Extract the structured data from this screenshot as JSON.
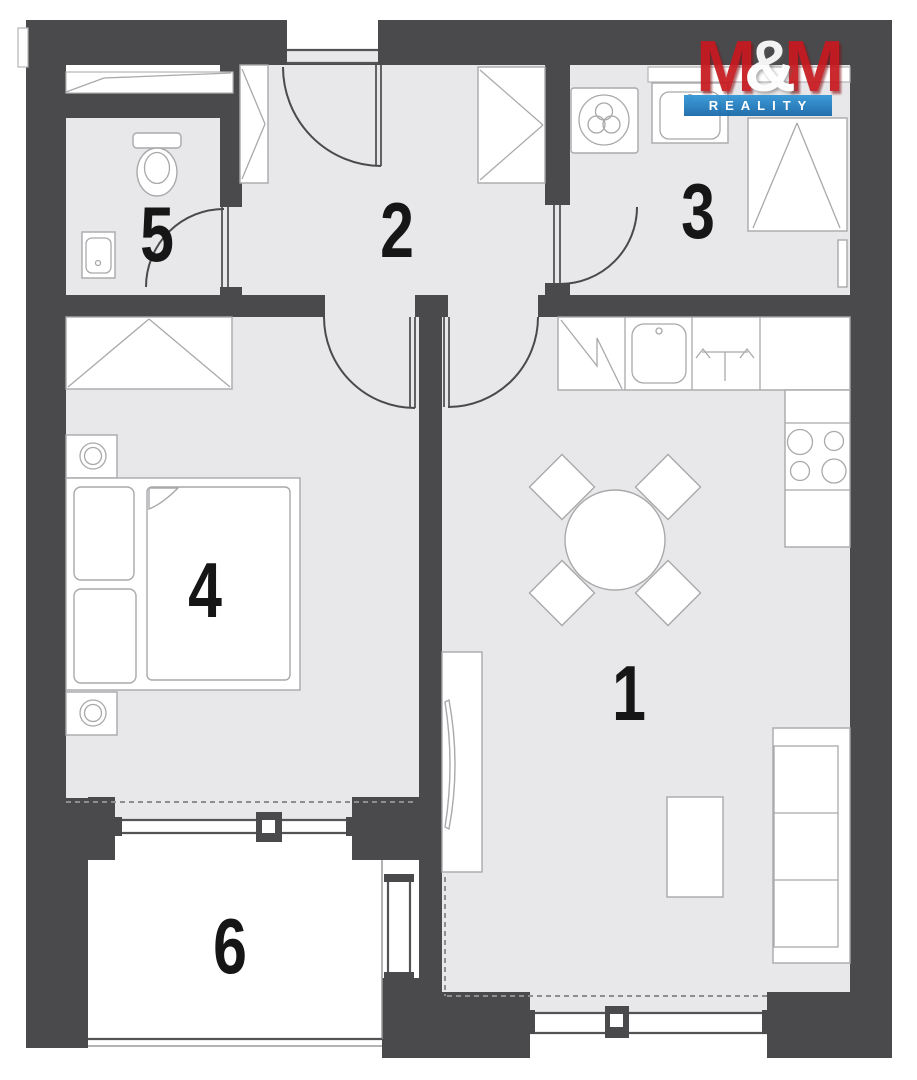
{
  "logo": {
    "m1": "M",
    "amp": "&",
    "m2": "M",
    "subtitle": "REALITY",
    "red": "#c7191f",
    "blue_top": "#2f95d6",
    "blue_bottom": "#1566a8"
  },
  "colors": {
    "wall": "#4a4a4c",
    "floor": "#e8e8ea",
    "balcony": "#ffffff",
    "furniture_stroke": "#a9a9ab",
    "label": "#161616"
  },
  "rooms": [
    {
      "label": "1"
    },
    {
      "label": "2"
    },
    {
      "label": "3"
    },
    {
      "label": "4"
    },
    {
      "label": "5"
    },
    {
      "label": "6"
    }
  ]
}
